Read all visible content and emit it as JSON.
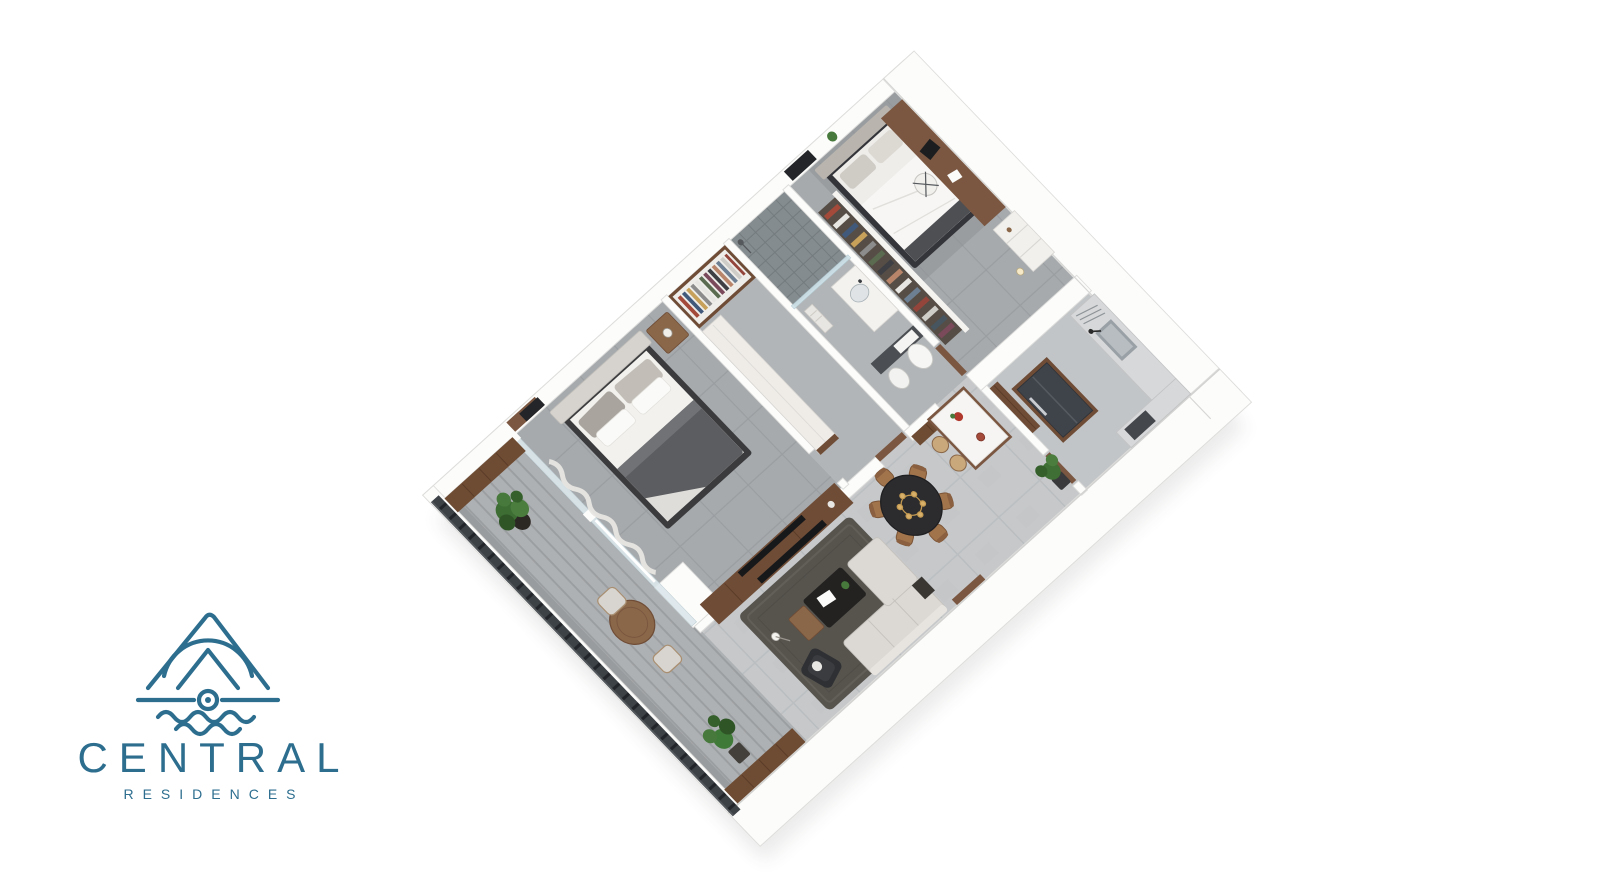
{
  "brand": {
    "name": "CENTRAL",
    "tagline": "RESIDENCES",
    "color": "#2d6e8f"
  },
  "scene": {
    "type": "3d-isometric-floorplan-render",
    "background": "#ffffff",
    "palette": {
      "wall": "#fcfcfb",
      "floor_open": "#c6c8ca",
      "floor_bedroom": "#a6aaad",
      "floor_balcony": "#aeb1b3",
      "wood": "#7b5741",
      "wood_dark": "#5f4430",
      "dark_furniture": "#2c2c2e",
      "railing": "#3d4247",
      "greenery": "#3f6f35",
      "shower_tile": "#858c90"
    },
    "rooms": [
      {
        "name": "Balcony",
        "furniture": [
          "slatted railing",
          "privacy wood screens",
          "round outdoor table",
          "two chairs",
          "two potted plants"
        ]
      },
      {
        "name": "Master Bedroom",
        "furniture": [
          "double bed",
          "nightstand with lamp",
          "wall art",
          "sheer curtain",
          "media wall with tv"
        ]
      },
      {
        "name": "Walk-in Closet",
        "furniture": [
          "open wardrobe with clothes",
          "closed wardrobe"
        ]
      },
      {
        "name": "Bathroom",
        "furniture": [
          "walk-in tiled shower",
          "vanity sink",
          "towel shelf",
          "toilet",
          "bidet"
        ]
      },
      {
        "name": "Bedroom 2",
        "furniture": [
          "double bed",
          "open wardrobe with clothes",
          "desk with laptop",
          "office chair",
          "wall tv",
          "shelving unit",
          "plant"
        ]
      },
      {
        "name": "Kitchen",
        "furniture": [
          "refrigerator with wood surround",
          "pantry doors",
          "sink counter with faucet",
          "dish rack",
          "appliance counter"
        ]
      },
      {
        "name": "Living / Dining",
        "furniture": [
          "area rug",
          "sectional sofa",
          "black lounge chair",
          "coffee table",
          "wood side table",
          "floor lamp",
          "media wall with tv",
          "round dining table",
          "six dining chairs",
          "gold chandelier",
          "kitchen island",
          "two bar stools",
          "potted plant"
        ]
      }
    ]
  }
}
